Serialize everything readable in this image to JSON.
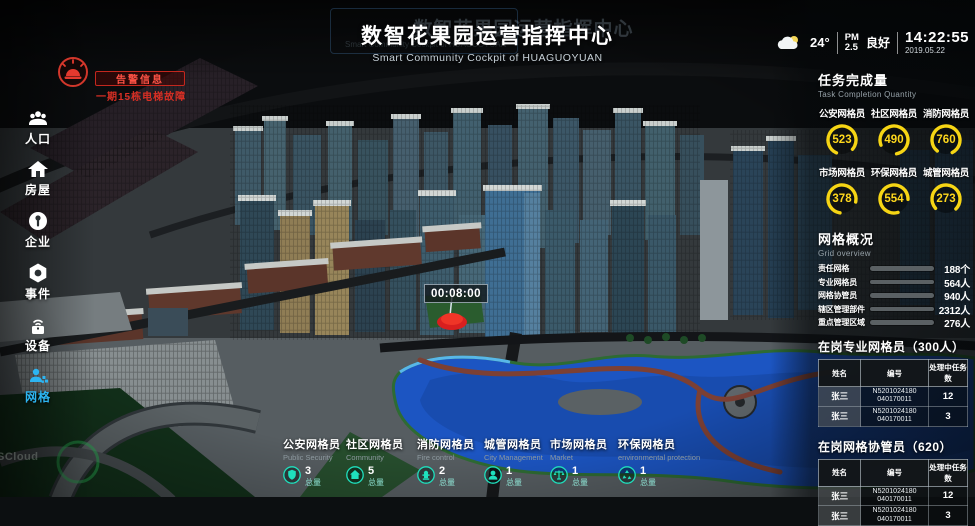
{
  "title": {
    "main": "数智花果园运营指挥中心",
    "sub": "Smart Community Cockpit of HUAGUOYUAN"
  },
  "topbar": {
    "temperature": "24°",
    "pm_label": "PM",
    "pm_value": "2.5",
    "air_quality": "良好",
    "time": "14:22:55",
    "date": "2019.05.22"
  },
  "alarm": {
    "title": "告警信息",
    "message": "一期15栋电梯故障"
  },
  "sidebar": {
    "items": [
      {
        "label": "人口"
      },
      {
        "label": "房屋"
      },
      {
        "label": "企业"
      },
      {
        "label": "事件"
      },
      {
        "label": "设备"
      },
      {
        "label": "网格"
      }
    ]
  },
  "task_panel": {
    "title": "任务完成量",
    "subtitle": "Task Completion Quantity",
    "gauges": [
      {
        "label": "公安网格员",
        "value": 523
      },
      {
        "label": "社区网格员",
        "value": 490
      },
      {
        "label": "消防网格员",
        "value": 760
      },
      {
        "label": "市场网格员",
        "value": 378
      },
      {
        "label": "环保网格员",
        "value": 554
      },
      {
        "label": "城管网格员",
        "value": 273
      }
    ]
  },
  "grid_overview": {
    "title": "网格概况",
    "subtitle": "Grid overview",
    "rows": [
      {
        "label": "责任网格",
        "value": "188个",
        "fill_pct": 87
      },
      {
        "label": "专业网格员",
        "value": "564人",
        "fill_pct": 80
      },
      {
        "label": "网格协管员",
        "value": "940人",
        "fill_pct": 60
      },
      {
        "label": "辖区管理部件",
        "value": "2312人",
        "fill_pct": 50
      },
      {
        "label": "重点管理区域",
        "value": "276人",
        "fill_pct": 42
      }
    ]
  },
  "tables": [
    {
      "title": "在岗专业网格员（300人）",
      "headers": [
        "姓名",
        "编号",
        "处理中任务数"
      ],
      "rows": [
        {
          "name": "张三",
          "id1": "N5201024180",
          "id2": "040170011",
          "tasks": "12"
        },
        {
          "name": "张三",
          "id1": "N5201024180",
          "id2": "040170011",
          "tasks": "3"
        }
      ]
    },
    {
      "title": "在岗网格协管员（620）",
      "headers": [
        "姓名",
        "编号",
        "处理中任务数"
      ],
      "rows": [
        {
          "name": "张三",
          "id1": "N5201024180",
          "id2": "040170011",
          "tasks": "12"
        },
        {
          "name": "张三",
          "id1": "N5201024180",
          "id2": "040170011",
          "tasks": "3"
        }
      ]
    }
  ],
  "bottom_stats": [
    {
      "label": "公安网格员",
      "sublabel": "Public Security",
      "count": "3",
      "unit": "总量"
    },
    {
      "label": "社区网格员",
      "sublabel": "Community",
      "count": "5",
      "unit": "总量"
    },
    {
      "label": "消防网格员",
      "sublabel": "Fire control",
      "count": "2",
      "unit": "总量"
    },
    {
      "label": "城管网格员",
      "sublabel": "City Management",
      "count": "1",
      "unit": "总量"
    },
    {
      "label": "市场网格员",
      "sublabel": "Market",
      "count": "1",
      "unit": "总量"
    },
    {
      "label": "环保网格员",
      "sublabel": "environmental protection",
      "count": "1",
      "unit": "总量"
    }
  ],
  "map": {
    "time_marker": "00:08:00",
    "watermark": "SCloud"
  },
  "colors": {
    "accent_blue": "#1e8ff2",
    "gauge_yellow": "#f6d514",
    "alarm_red": "#e5392e",
    "stat_teal": "#1fe0bd",
    "sidebar_active": "#2db5f2"
  }
}
